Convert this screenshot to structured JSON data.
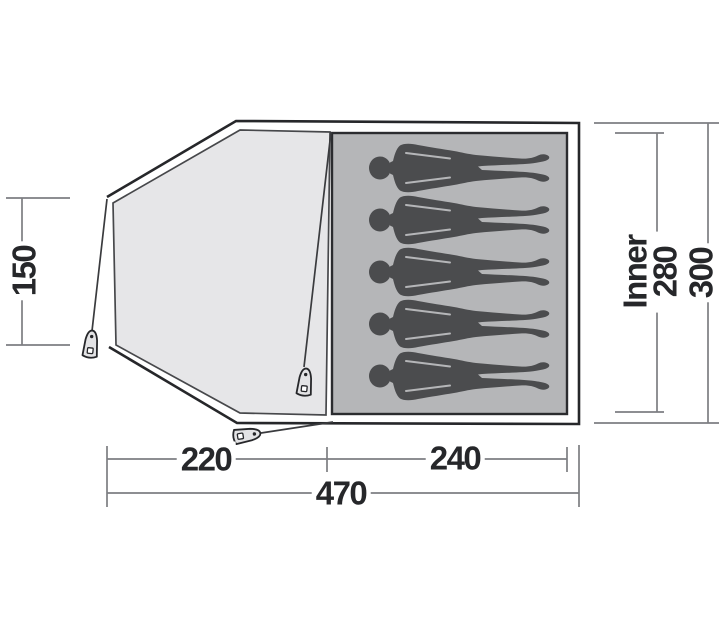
{
  "diagram": {
    "type": "tent-floorplan-top-view",
    "capacity_persons": 5,
    "dimensions": {
      "porch_depth": "150",
      "porch_width": "220",
      "inner_width": "240",
      "total_width": "470",
      "inner_label": "Inner",
      "inner_depth": "280",
      "total_depth": "300"
    },
    "colors": {
      "background": "#ffffff",
      "outline": "#26272a",
      "guy_line": "#3a3b3e",
      "dimension_line": "#7d7e82",
      "label_color": "#26272a",
      "porch_fill": "#e6e6e8",
      "porch_stroke": "#47484b",
      "inner_fill": "#b5b6b8",
      "inner_stroke": "#2b2c2f",
      "person_fill": "#4b4c4e",
      "peg_fill": "#e3e3e5",
      "peg_hole_fill": "#ffffff"
    }
  }
}
